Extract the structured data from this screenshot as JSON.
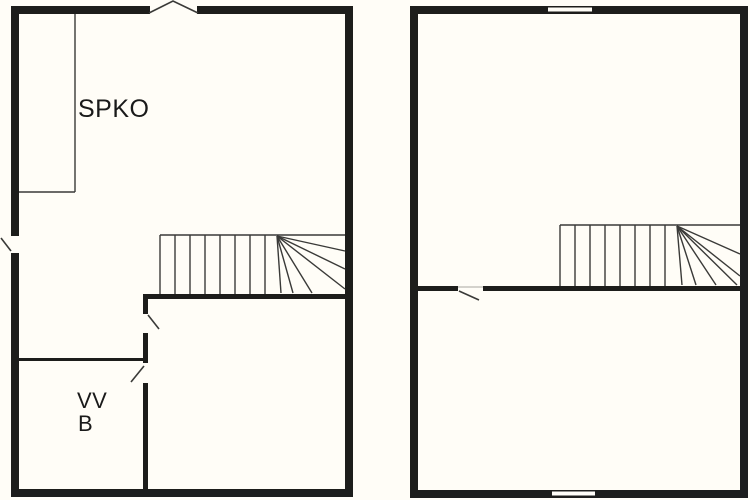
{
  "colors": {
    "background": "#fffdf7",
    "wall": "#1d1d1b",
    "line": "#3a3a38",
    "text": "#1a1a1a"
  },
  "left_plan": {
    "labels": {
      "closet": "SPKO",
      "room_line1": "VV",
      "room_line2": "B"
    }
  },
  "right_plan": {
    "labels": {}
  }
}
